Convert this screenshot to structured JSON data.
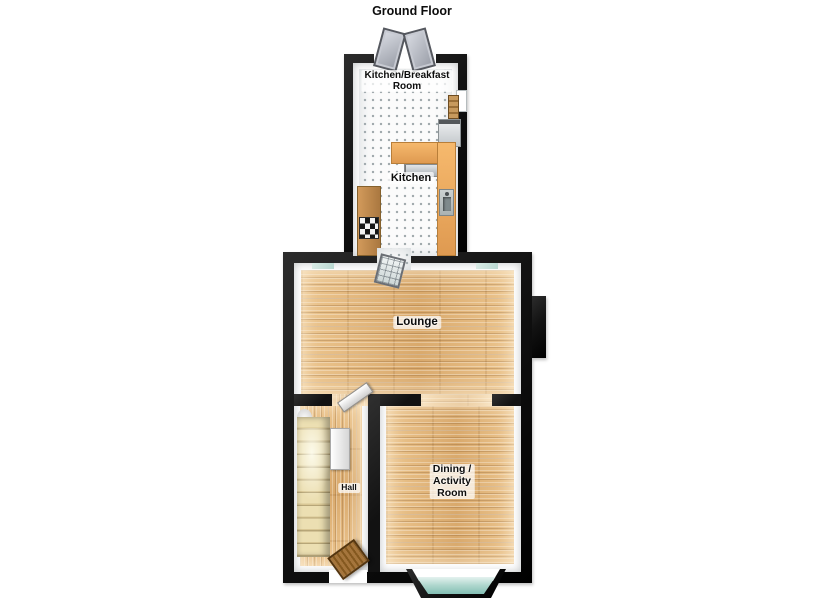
{
  "title": "Ground Floor",
  "rooms": {
    "kitchen_breakfast": {
      "lines": [
        "Kitchen/Breakfast",
        "Room"
      ]
    },
    "kitchen": {
      "label": "Kitchen"
    },
    "lounge": {
      "label": "Lounge"
    },
    "hall": {
      "label": "Hall"
    },
    "dining": {
      "lines": [
        "Dining /",
        "Activity",
        "Room"
      ]
    }
  },
  "fixtures": {
    "french_doors": "double doors opening outward",
    "breakfast_window": "window",
    "shelf_unit": "wooden shelf unit",
    "tall_unit": "tall appliance unit",
    "worktop_top": "worktop",
    "worktop_right": "worktop with sink",
    "worktop_left": "worktop with hob",
    "sink": "sink",
    "hob": "four ring hob",
    "kitchen_door": "glazed door to lounge",
    "chimney_breast": "chimney breast",
    "hall_door": "door lounge to hall",
    "staircase": "staircase",
    "cupboard": "hall cupboard",
    "front_door": "front door",
    "bay_window": "bay window"
  },
  "colors": {
    "wall": "#121212",
    "tile": "#fbfbfb",
    "tile_dot": "#9fa8ab",
    "wood_light": "#ecc58e",
    "wood_dark": "#d9a96c",
    "counter_light": "#f6b96d",
    "counter_dark": "#df9a51",
    "counter_wood_light": "#d29a5b",
    "counter_wood_dark": "#aa7840",
    "stairs_light": "#ecdfb2",
    "stairs_dark": "#b7a678",
    "glass_light": "#e4f2ef",
    "glass_dark": "#84bfb4",
    "door_brown_light": "#a5753c",
    "door_brown_dark": "#84581f",
    "leaf_light": "#d9dce3",
    "leaf_dark": "#989ca6"
  }
}
